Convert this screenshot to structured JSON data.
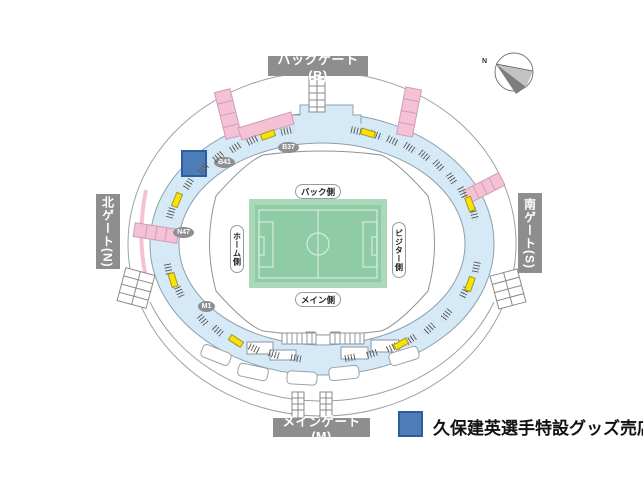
{
  "gates": {
    "back": {
      "label": "バックゲート(B)"
    },
    "main": {
      "label": "メインゲート(M)"
    },
    "north": {
      "label": "北ゲート(N)"
    },
    "south": {
      "label": "南ゲート(S)"
    }
  },
  "stands": {
    "back": {
      "label": "バック側"
    },
    "main": {
      "label": "メイン側"
    },
    "home": {
      "label": "ホーム側"
    },
    "visitor": {
      "label": "ビジター側"
    }
  },
  "sections": [
    {
      "label": "B37"
    },
    {
      "label": "B41"
    },
    {
      "label": "N47"
    },
    {
      "label": "M1"
    }
  ],
  "legend": {
    "items": [
      {
        "label": "久保建英選手特設グッズ売店",
        "swatch_color": "#4d7db8"
      }
    ]
  },
  "compass": {
    "north_label": "N"
  },
  "colors": {
    "concourse_blue": "#d6e9f7",
    "stairs_pink": "#f5c2d5",
    "vendor_yellow": "#ffe100",
    "shop_blue": "#4d7db8",
    "shop_blue_border": "#2c5d9c",
    "gate_gray": "#8e8e8e",
    "badge_gray": "#8f8f8f",
    "pitch_green": "#8fcba4",
    "pitch_margin_green": "#abd8b8"
  }
}
